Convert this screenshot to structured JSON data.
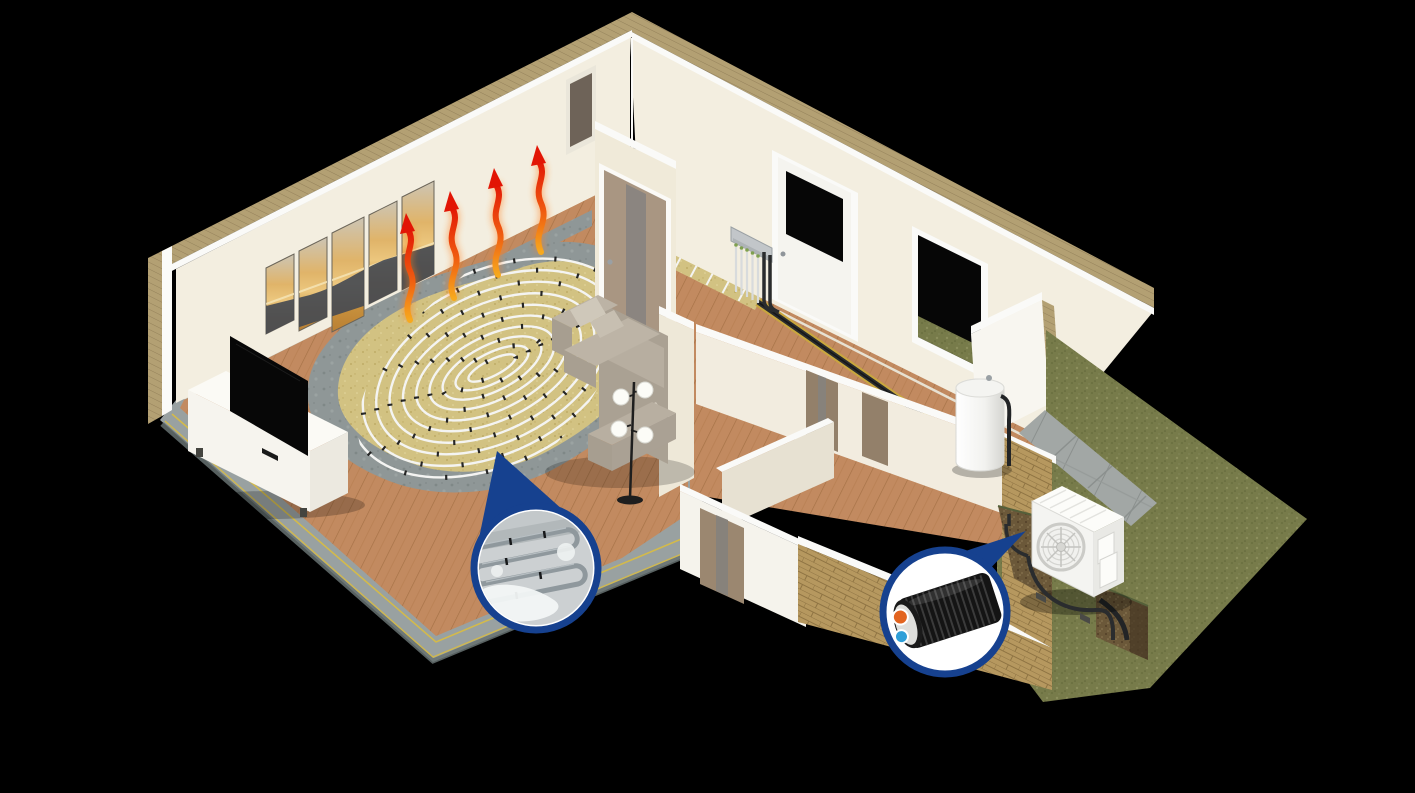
{
  "illustration": {
    "kind": "isometric-cutaway-3d-render",
    "subject": "house heating system with air-source heat pump, underfloor heating coils, manifold, buffer tank and insulated outdoor pipe",
    "rooms": [
      "living-room",
      "vestibule",
      "hallway",
      "front-rooms",
      "garden"
    ],
    "components": [
      "living-room-back-wall",
      "wall-art-5-panels",
      "heat-rise-arrows",
      "tv",
      "tv-console",
      "underfloor-heating-cutaway",
      "screed-ring",
      "heating-coil",
      "sofa",
      "floor-lamp",
      "interior-door",
      "vestibule-door",
      "hallway-wall",
      "hallway-door",
      "hallway-window",
      "heating-manifold",
      "floor-pipe-channel",
      "hallway-heating-strip",
      "water-buffer-tank",
      "gable-wall",
      "front-wall-white",
      "front-wall-brick",
      "wood-wardrobe-panels",
      "grass-lawn",
      "paving-walkway",
      "pipe-trench",
      "outdoor-heat-pump",
      "callout-screed-pipes",
      "callout-insulated-pipe"
    ],
    "callouts": [
      {
        "name": "screed-pipes-magnifier",
        "shape": "teardrop",
        "content": "heating pipes embedded in wet screed"
      },
      {
        "name": "insulated-pipe-magnifier",
        "shape": "circle-with-pointer",
        "content": "black corrugated casing with orange flow and blue return pipe"
      }
    ]
  },
  "counts": {
    "heat_arrows": 4,
    "art_panels": 5,
    "lamp_globes": 4,
    "manifold_loops": 5,
    "coil_rings": 10
  },
  "colors": {
    "background": "#000000",
    "wall": "#f3eee0",
    "wall_shaded": "#ece5d2",
    "wall_cap": "#fafaf8",
    "wall_insulation": "#b3a073",
    "wood_floor": "#c28a60",
    "plank_line": "#a57146",
    "slab": "#99a1a1",
    "slab_yellow": "#d9bc41",
    "concrete_ring": "#8f9797",
    "insulation_panel": "#d2c282",
    "heating_pipe": "#f4f4f2",
    "clip_black": "#1c1c1c",
    "sofa": "#aaa193",
    "sofa_light": "#c7bfb1",
    "lamp_black": "#1e1e1e",
    "lamp_globe": "#fcfcf7",
    "tv_black": "#070707",
    "console_white": "#f6f4ee",
    "door_wood": "#a99682",
    "door_panel": "#8b8580",
    "window_black": "#060606",
    "manifold_silver": "#c2c6c9",
    "pipe_black": "#2a2c2e",
    "tank_white": "#f4f4f1",
    "brick": "#b6985f",
    "mortar": "#8f7443",
    "grass": "#777b4a",
    "paving": "#a2a7a5",
    "soil": "#6b5839",
    "heat_pump_white": "#f4f4f1",
    "fan_grey": "#cbcbc7",
    "callout_blue": "#16418f",
    "screed_grey": "#ccd0d2",
    "screed_pipe": "#8f989d",
    "arrow_red": "#e21505",
    "arrow_orange": "#f7a91e",
    "pipe_orange": "#e2641f",
    "pipe_blue": "#2f9fd8",
    "art_sky": "#ccc5b5",
    "art_amber": "#e0b469",
    "art_deep": "#b97f33",
    "art_mountain": "#474b52"
  }
}
